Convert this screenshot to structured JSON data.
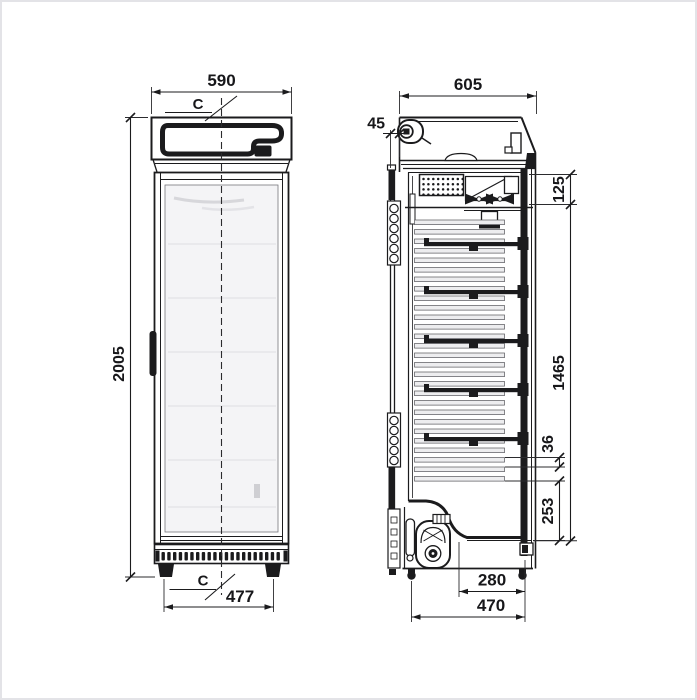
{
  "dims": {
    "front_width": "590",
    "front_center_top": "C",
    "front_height": "2005",
    "front_feet_span": "477",
    "front_center_bottom": "C",
    "side_depth": "605",
    "side_door_offset": "45",
    "side_top_section": "125",
    "side_shelf_section": "1465",
    "side_slot_pitch": "36",
    "side_bottom_section": "253",
    "side_base_inner_depth": "280",
    "side_base_depth": "470"
  },
  "colors": {
    "ink": "#1b1b1d",
    "glass": "#f4f4f6",
    "slat_fill": "#ededef",
    "slat_edge": "#55555a",
    "faint_line": "#e2e2e6",
    "reflection": "#d7d7db",
    "sticker": "#cfcfd3",
    "page_border": "#e3e3e7",
    "background": "#ffffff"
  }
}
